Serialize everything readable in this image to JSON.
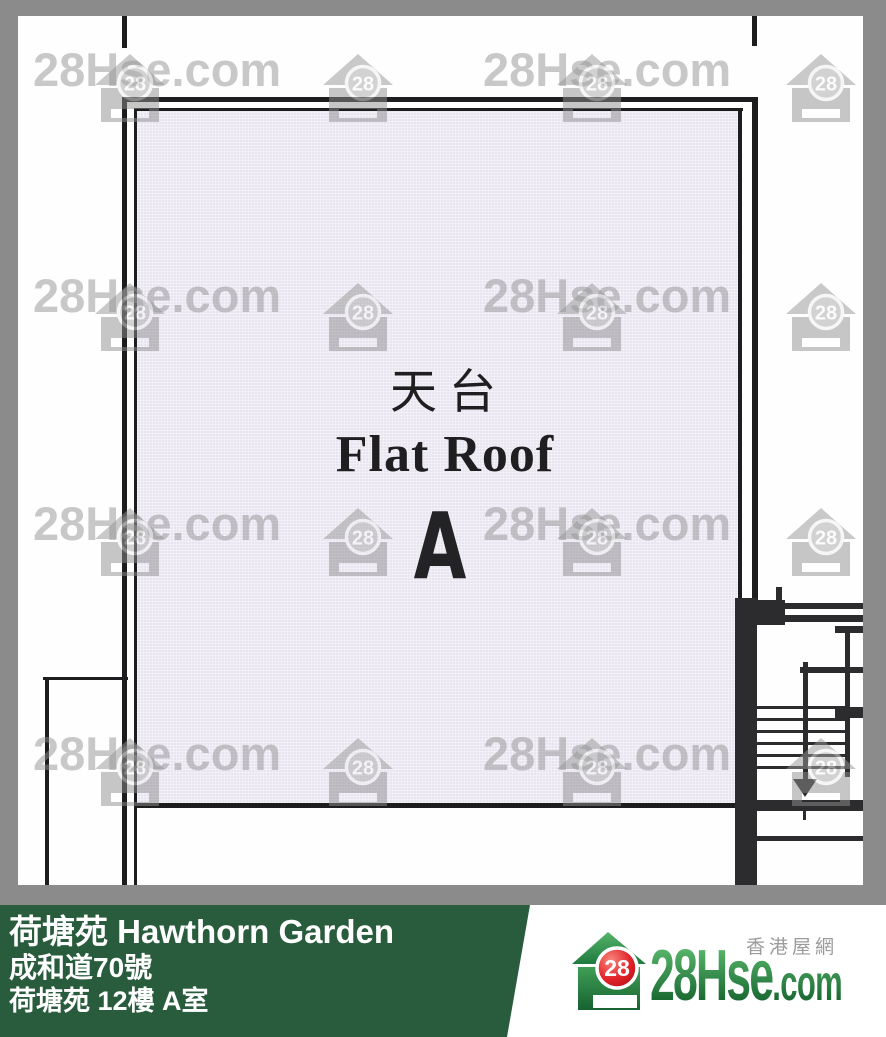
{
  "plan": {
    "area_label_zh": "天台",
    "area_label_en": "Flat Roof",
    "unit_letter": "A"
  },
  "watermark": {
    "text": "28Hse.com",
    "badge": "28"
  },
  "footer": {
    "estate_title": "荷塘苑 Hawthorn Garden",
    "address_line": "成和道70號",
    "unit_line": "荷塘苑 12樓 A室",
    "site_label_zh": "香港屋網",
    "brand_main": "28Hse",
    "brand_suffix": ".com",
    "badge": "28"
  },
  "colors": {
    "footer_green": "#295c3d",
    "brand_green": "#2e8c4a",
    "badge_red": "#c20d18",
    "frame_gray": "#8b8b8b",
    "roof_fill": "#e9e5f0"
  }
}
